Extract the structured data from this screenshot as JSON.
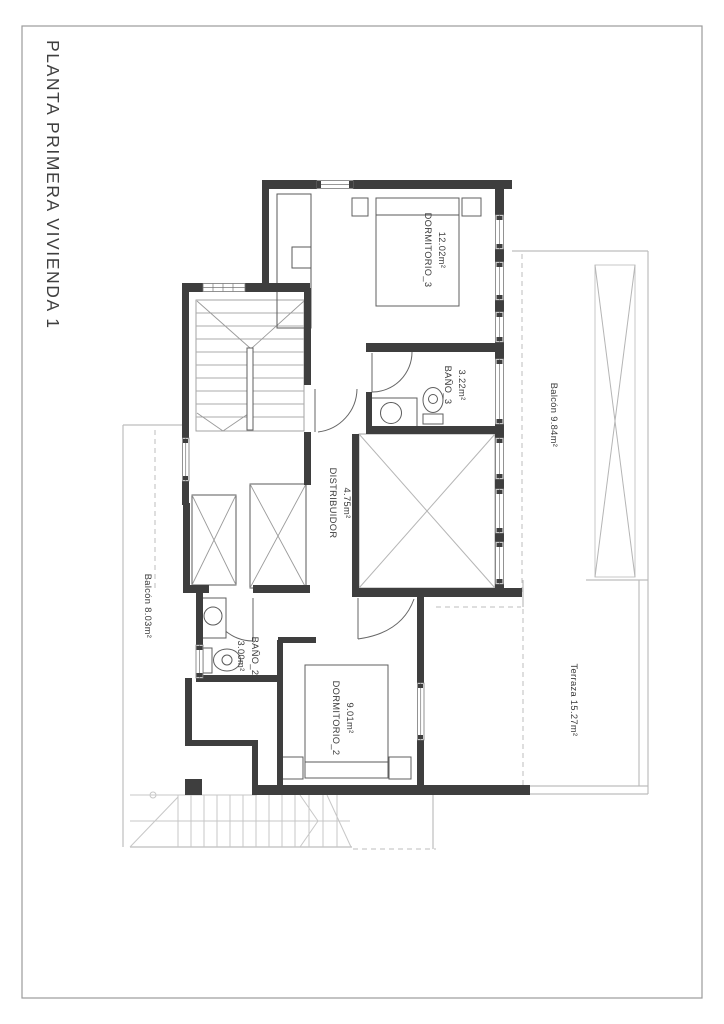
{
  "page": {
    "title": "PLANTA PRIMERA VIVIENDA 1"
  },
  "rooms": [
    {
      "id": "dormitorio_3",
      "name": "DORMITORIO_3",
      "area": "12.02m²"
    },
    {
      "id": "bano_3",
      "name": "BAÑO_3",
      "area": "3.22m²"
    },
    {
      "id": "distribuidor",
      "name": "DISTRIBUIDOR",
      "area": "4.75m²"
    },
    {
      "id": "balcon_right",
      "name": "Balcón",
      "area": "9.84m²",
      "label": "Balcón 9.84m²"
    },
    {
      "id": "balcon_left",
      "name": "Balcón",
      "area": "8.03m²",
      "label": "Balcón 8.03m²"
    },
    {
      "id": "bano_2",
      "name": "BAÑO_2",
      "area": "3.00m²"
    },
    {
      "id": "dormitorio_2",
      "name": "DORMITORIO_2",
      "area": "9.01m²"
    },
    {
      "id": "terraza",
      "name": "Terraza",
      "area": "15.27m²",
      "label": "Terraza 15.27m²"
    }
  ]
}
